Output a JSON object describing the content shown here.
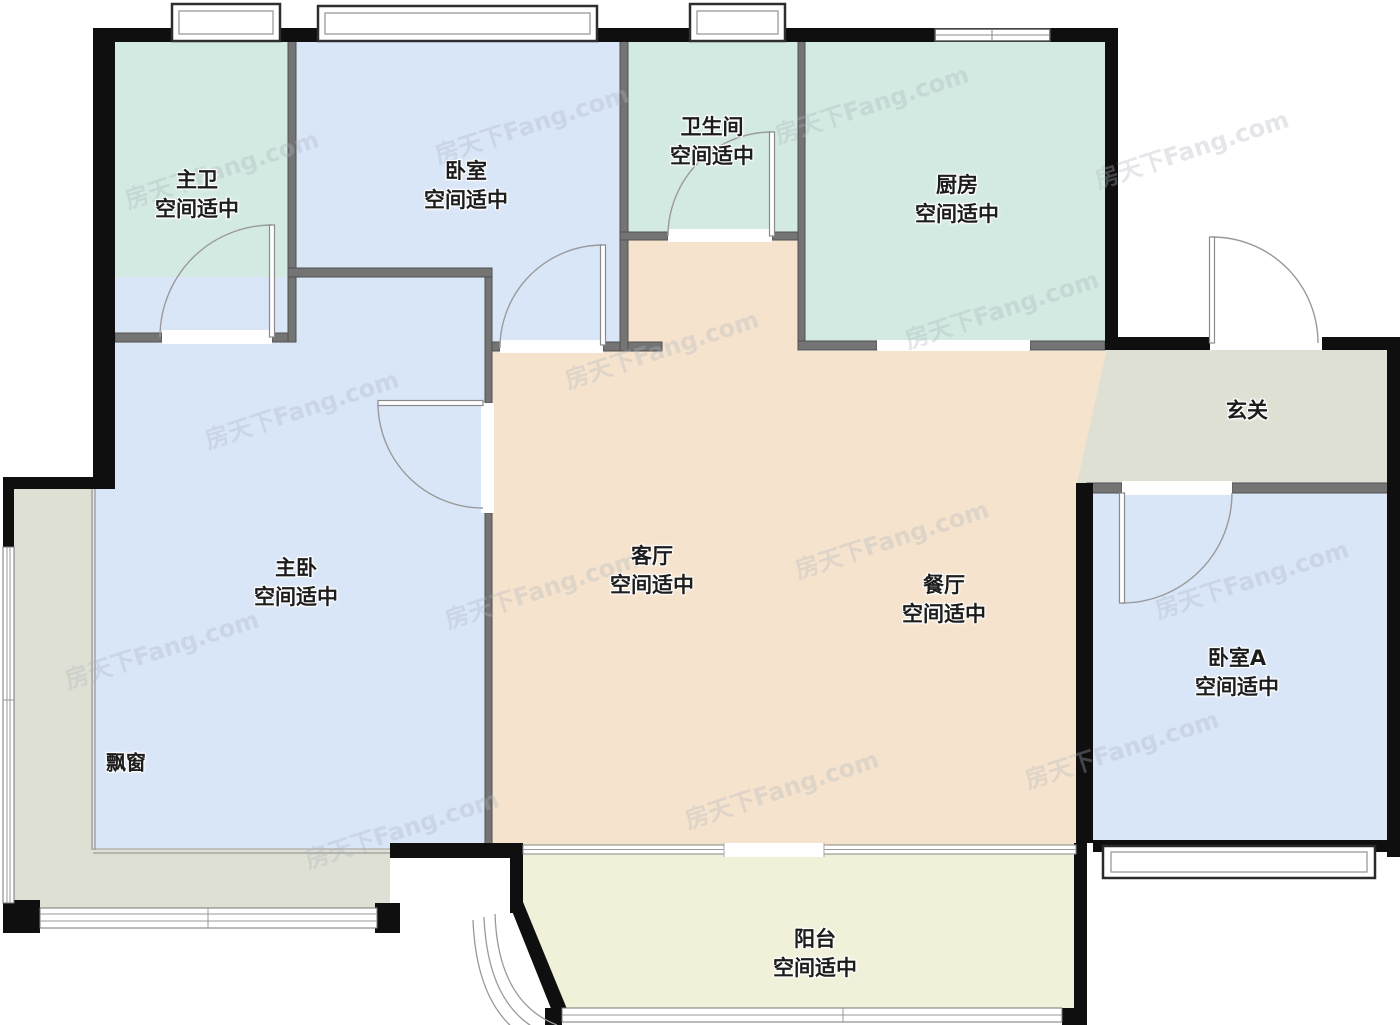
{
  "title": "户型图",
  "watermark": {
    "text": "房天下Fang.com"
  },
  "rooms": [
    {
      "id": "master-bath",
      "name": "主卫",
      "note": "空间适中"
    },
    {
      "id": "bedroom-top",
      "name": "卧室",
      "note": "空间适中"
    },
    {
      "id": "bathroom",
      "name": "卫生间",
      "note": "空间适中"
    },
    {
      "id": "kitchen",
      "name": "厨房",
      "note": "空间适中"
    },
    {
      "id": "entry",
      "name": "玄关",
      "note": ""
    },
    {
      "id": "master-bed",
      "name": "主卧",
      "note": "空间适中"
    },
    {
      "id": "living",
      "name": "客厅",
      "note": "空间适中"
    },
    {
      "id": "dining",
      "name": "餐厅",
      "note": "空间适中"
    },
    {
      "id": "bedroom-a",
      "name": "卧室A",
      "note": "空间适中"
    },
    {
      "id": "balcony",
      "name": "阳台",
      "note": "空间适中"
    },
    {
      "id": "bay-window",
      "name": "飘窗",
      "note": ""
    }
  ],
  "colors": {
    "bedroom_blue": "#d9e6f8",
    "bath_teal": "#d3eae2",
    "living_tan": "#f6e3cd",
    "balcony_yellow": "#f1f0d9",
    "gray_zone": "#dfe0d4",
    "wall_black": "#0f0f0f",
    "wall_gray": "#747474"
  }
}
